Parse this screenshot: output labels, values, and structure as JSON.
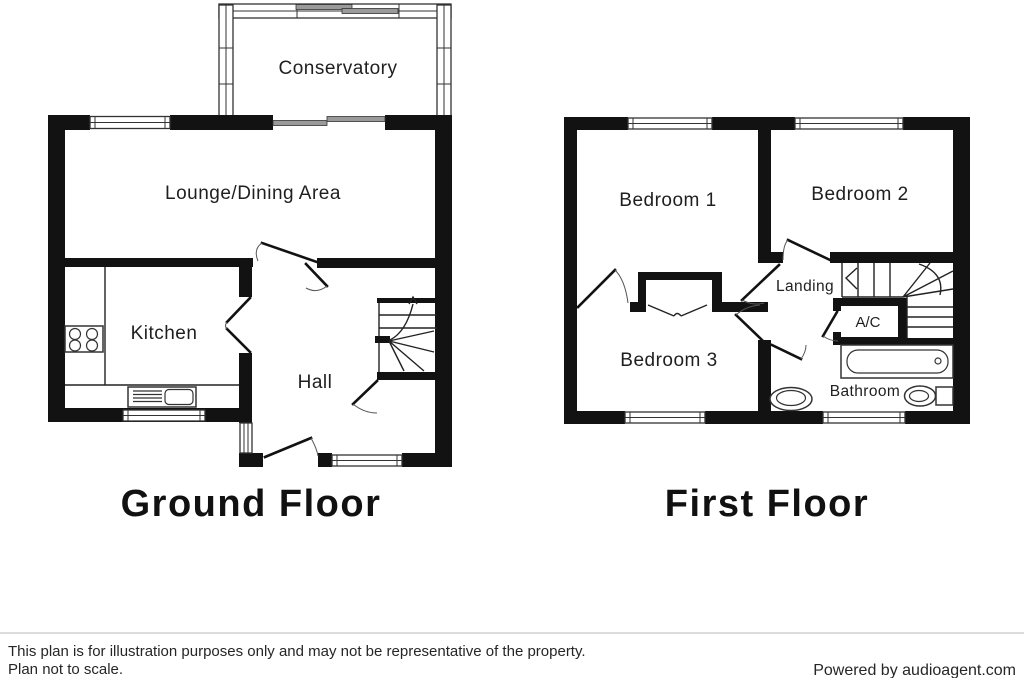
{
  "document": {
    "background_color": "#ffffff",
    "wall_color": "#121212"
  },
  "floors": {
    "ground": {
      "title": "Ground Floor",
      "rooms": {
        "conservatory": "Conservatory",
        "lounge": "Lounge/Dining Area",
        "kitchen": "Kitchen",
        "hall": "Hall"
      }
    },
    "first": {
      "title": "First Floor",
      "rooms": {
        "bedroom1": "Bedroom 1",
        "bedroom2": "Bedroom 2",
        "bedroom3": "Bedroom 3",
        "landing": "Landing",
        "ac": "A/C",
        "bathroom": "Bathroom"
      }
    }
  },
  "footer": {
    "disclaimer_line1": "This plan is for illustration purposes only and may not be representative of the property.",
    "disclaimer_line2": "Plan not to scale.",
    "credit": "Powered by audioagent.com"
  }
}
